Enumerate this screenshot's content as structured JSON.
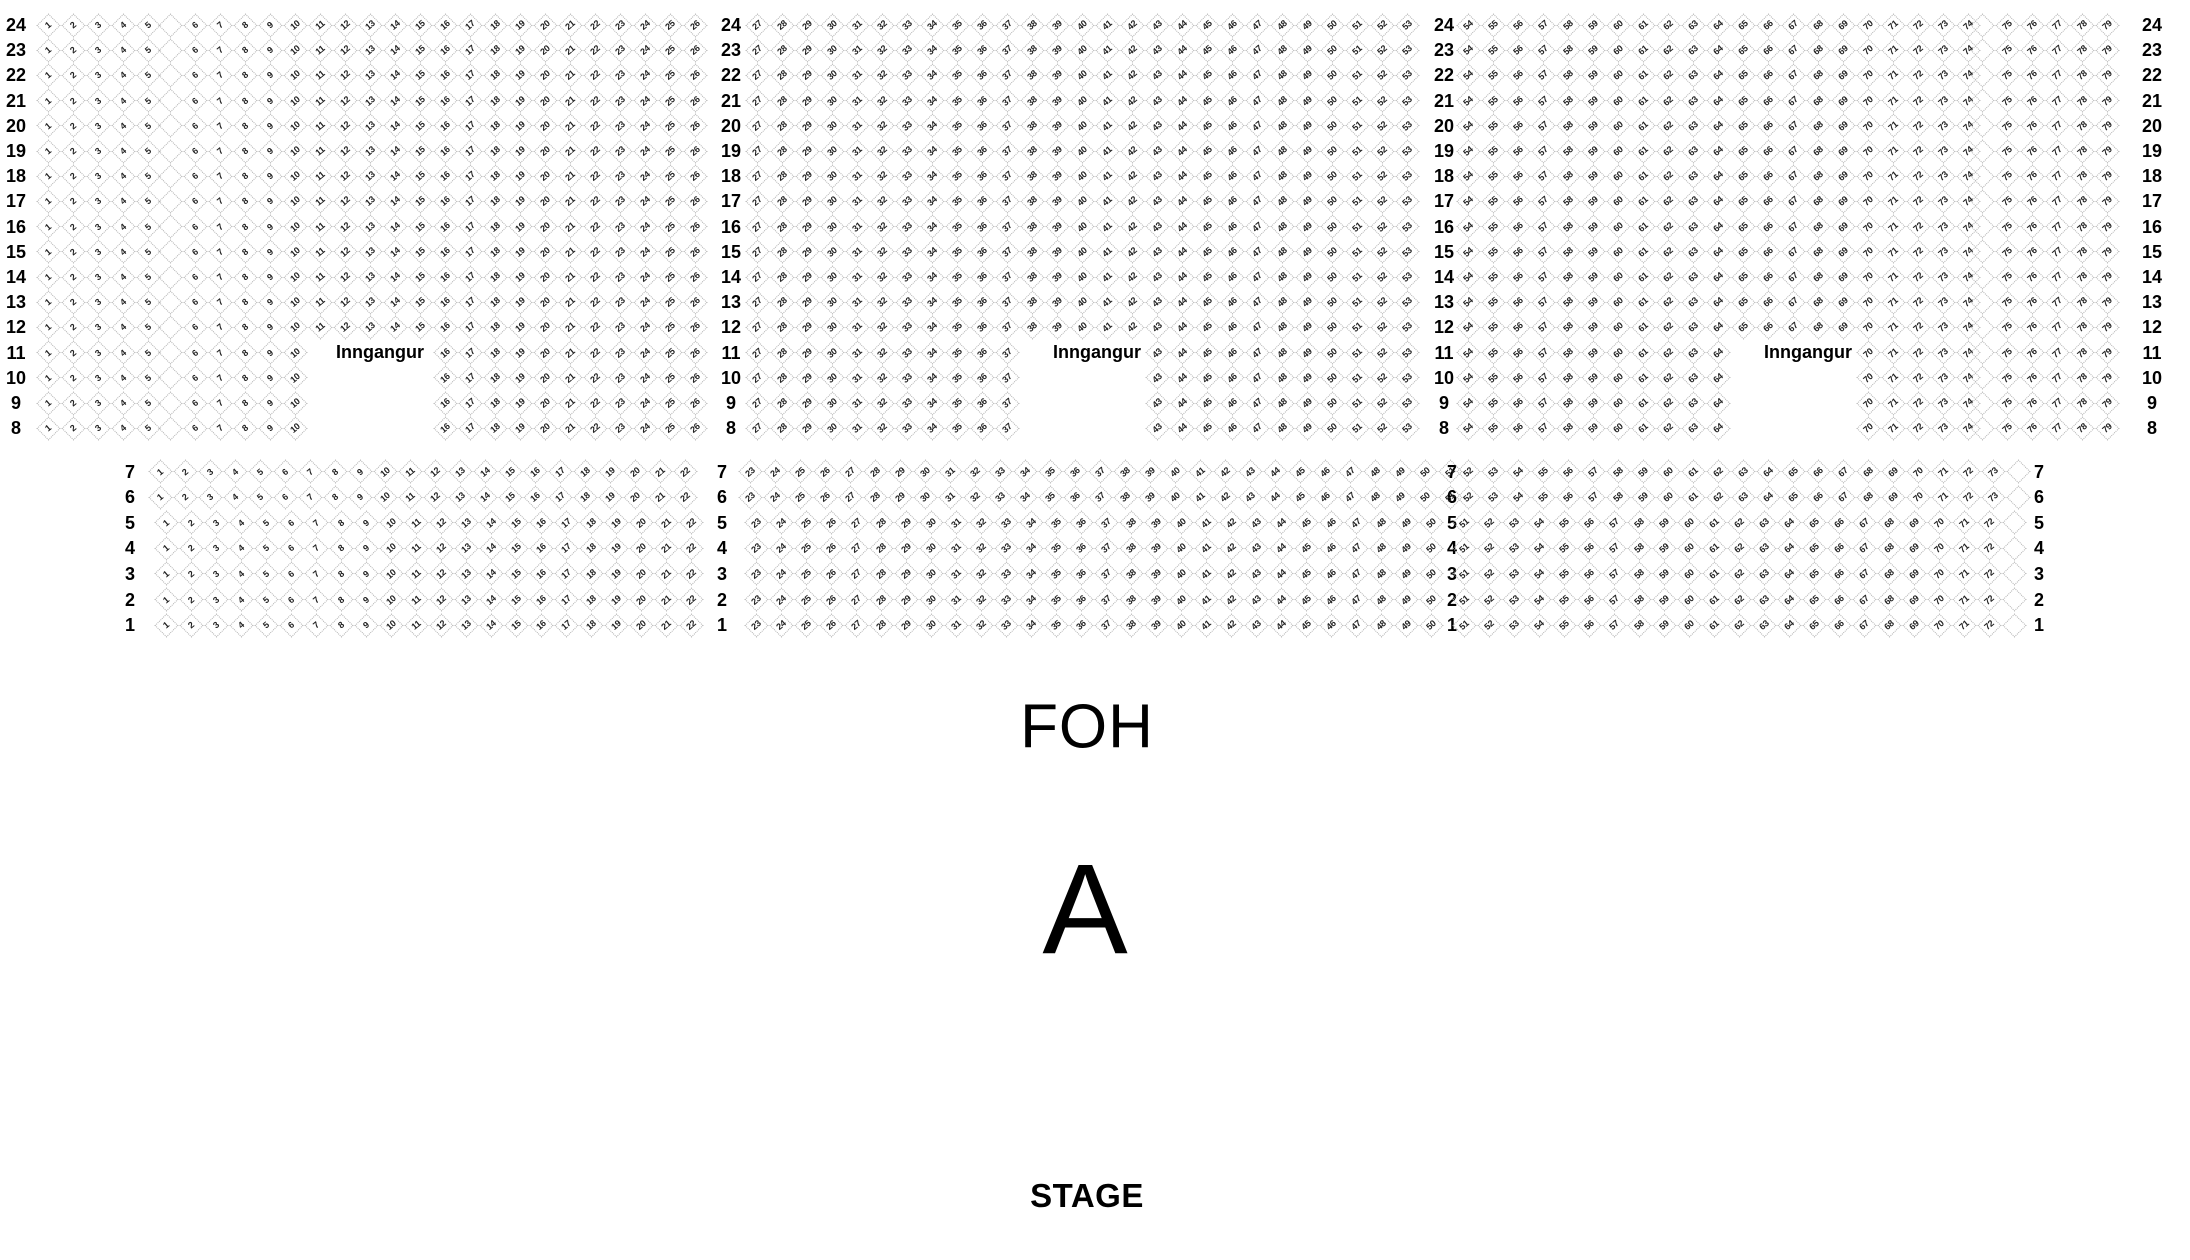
{
  "labels": {
    "foh": "FOH",
    "section": "A",
    "stage": "STAGE"
  },
  "entrances": [
    "Inngangur",
    "Inngangur",
    "Inngangur"
  ],
  "colors": {
    "seat_border": "#b0b0b0",
    "seat_text": "#222222",
    "label_text": "#000000"
  },
  "upper_block": {
    "rows": [
      {
        "row": "24",
        "segments": [
          [
            1,
            5
          ],
          [
            6,
            26
          ],
          [
            27,
            53
          ],
          [
            54,
            74
          ],
          [
            75,
            79
          ]
        ]
      },
      {
        "row": "23",
        "segments": [
          [
            1,
            5
          ],
          [
            6,
            26
          ],
          [
            27,
            53
          ],
          [
            54,
            74
          ],
          [
            75,
            79
          ]
        ]
      },
      {
        "row": "22",
        "segments": [
          [
            1,
            5
          ],
          [
            6,
            26
          ],
          [
            27,
            53
          ],
          [
            54,
            74
          ],
          [
            75,
            79
          ]
        ]
      },
      {
        "row": "21",
        "segments": [
          [
            1,
            5
          ],
          [
            6,
            26
          ],
          [
            27,
            53
          ],
          [
            54,
            74
          ],
          [
            75,
            79
          ]
        ]
      },
      {
        "row": "20",
        "segments": [
          [
            1,
            5
          ],
          [
            6,
            26
          ],
          [
            27,
            53
          ],
          [
            54,
            74
          ],
          [
            75,
            79
          ]
        ]
      },
      {
        "row": "19",
        "segments": [
          [
            1,
            5
          ],
          [
            6,
            26
          ],
          [
            27,
            53
          ],
          [
            54,
            74
          ],
          [
            75,
            79
          ]
        ]
      },
      {
        "row": "18",
        "segments": [
          [
            1,
            5
          ],
          [
            6,
            26
          ],
          [
            27,
            53
          ],
          [
            54,
            74
          ],
          [
            75,
            79
          ]
        ]
      },
      {
        "row": "17",
        "segments": [
          [
            1,
            5
          ],
          [
            6,
            26
          ],
          [
            27,
            53
          ],
          [
            54,
            74
          ],
          [
            75,
            79
          ]
        ]
      },
      {
        "row": "16",
        "segments": [
          [
            1,
            5
          ],
          [
            6,
            26
          ],
          [
            27,
            53
          ],
          [
            54,
            74
          ],
          [
            75,
            79
          ]
        ]
      },
      {
        "row": "15",
        "segments": [
          [
            1,
            5
          ],
          [
            6,
            26
          ],
          [
            27,
            53
          ],
          [
            54,
            74
          ],
          [
            75,
            79
          ]
        ]
      },
      {
        "row": "14",
        "segments": [
          [
            1,
            5
          ],
          [
            6,
            26
          ],
          [
            27,
            53
          ],
          [
            54,
            74
          ],
          [
            75,
            79
          ]
        ]
      },
      {
        "row": "13",
        "segments": [
          [
            1,
            5
          ],
          [
            6,
            26
          ],
          [
            27,
            53
          ],
          [
            54,
            74
          ],
          [
            75,
            79
          ]
        ]
      },
      {
        "row": "12",
        "segments": [
          [
            1,
            5
          ],
          [
            6,
            26
          ],
          [
            27,
            53
          ],
          [
            54,
            74
          ],
          [
            75,
            79
          ]
        ]
      },
      {
        "row": "11",
        "segments": [
          [
            1,
            5
          ],
          [
            6,
            10
          ],
          [
            16,
            26
          ],
          [
            27,
            37
          ],
          [
            43,
            53
          ],
          [
            54,
            64
          ],
          [
            70,
            74
          ],
          [
            75,
            79
          ]
        ]
      },
      {
        "row": "10",
        "segments": [
          [
            1,
            5
          ],
          [
            6,
            10
          ],
          [
            16,
            26
          ],
          [
            27,
            37
          ],
          [
            43,
            53
          ],
          [
            54,
            64
          ],
          [
            70,
            74
          ],
          [
            75,
            79
          ]
        ]
      },
      {
        "row": "9",
        "segments": [
          [
            1,
            5
          ],
          [
            6,
            10
          ],
          [
            16,
            26
          ],
          [
            27,
            37
          ],
          [
            43,
            53
          ],
          [
            54,
            64
          ],
          [
            70,
            74
          ],
          [
            75,
            79
          ]
        ]
      },
      {
        "row": "8",
        "segments": [
          [
            1,
            5
          ],
          [
            6,
            10
          ],
          [
            16,
            26
          ],
          [
            27,
            37
          ],
          [
            43,
            53
          ],
          [
            54,
            64
          ],
          [
            70,
            74
          ],
          [
            75,
            79
          ]
        ]
      }
    ]
  },
  "lower_block": {
    "rows": [
      {
        "row": "7",
        "segments": [
          [
            1,
            22
          ],
          [
            23,
            51
          ],
          [
            52,
            73
          ]
        ]
      },
      {
        "row": "6",
        "segments": [
          [
            1,
            22
          ],
          [
            23,
            51
          ],
          [
            52,
            73
          ]
        ]
      },
      {
        "row": "5",
        "segments": [
          [
            1,
            22
          ],
          [
            23,
            50
          ],
          [
            51,
            72
          ]
        ]
      },
      {
        "row": "4",
        "segments": [
          [
            1,
            22
          ],
          [
            23,
            50
          ],
          [
            51,
            72
          ]
        ]
      },
      {
        "row": "3",
        "segments": [
          [
            1,
            22
          ],
          [
            23,
            50
          ],
          [
            51,
            72
          ]
        ]
      },
      {
        "row": "2",
        "segments": [
          [
            1,
            22
          ],
          [
            23,
            50
          ],
          [
            51,
            72
          ]
        ]
      },
      {
        "row": "1",
        "segments": [
          [
            1,
            22
          ],
          [
            23,
            50
          ],
          [
            51,
            72
          ]
        ]
      }
    ]
  }
}
